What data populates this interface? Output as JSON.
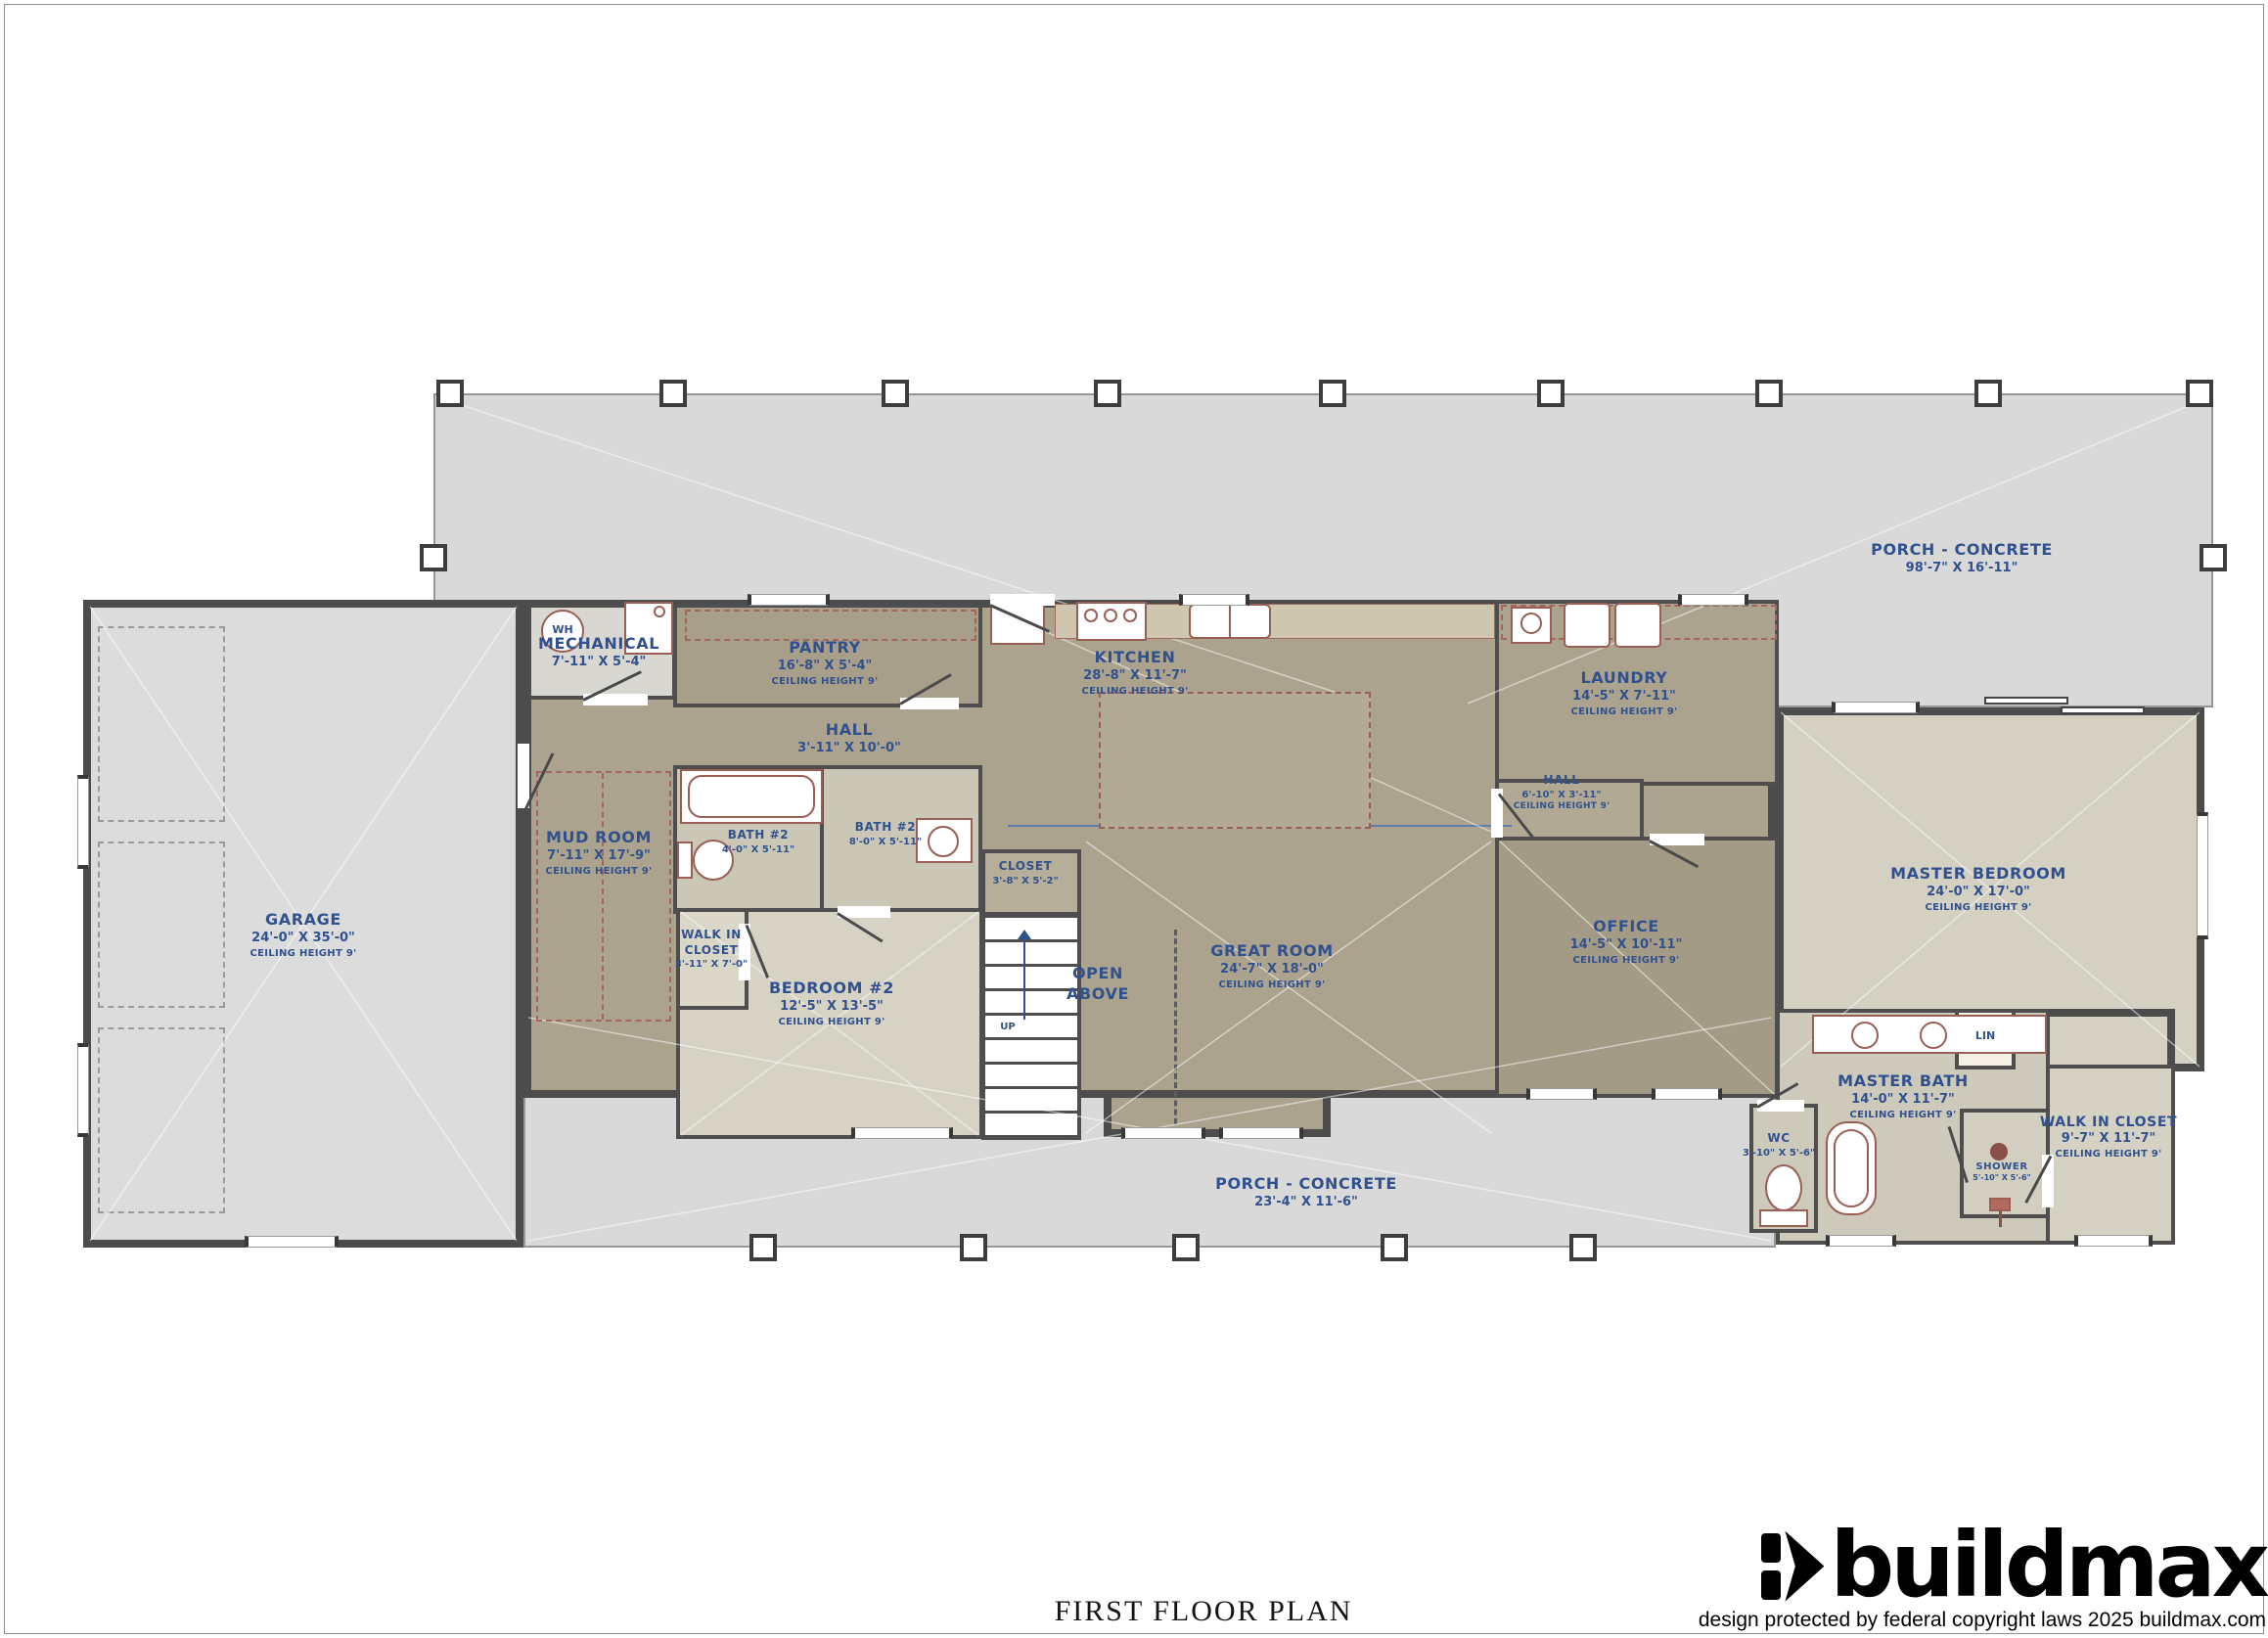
{
  "title": "FIRST FLOOR PLAN",
  "brand": {
    "wordmark": "buildmax",
    "copyright": "design protected by federal copyright laws 2025 buildmax.com"
  },
  "colors": {
    "label_blue": "#31518e",
    "wall_dark": "#4c4c4c",
    "porch_grey": "#d9d9d9",
    "room_taupe": "#aca38e",
    "room_light": "#d6d2c4",
    "bath_tan": "#cdc9bb",
    "fixture_red": "#995e54"
  },
  "rooms": {
    "porch_top": {
      "name": "PORCH - CONCRETE",
      "dims": "98'-7\" X 16'-11\""
    },
    "porch_bottom": {
      "name": "PORCH - CONCRETE",
      "dims": "23'-4\" X 11'-6\""
    },
    "garage": {
      "name": "GARAGE",
      "dims": "24'-0\" X 35'-0\"",
      "ceiling": "CEILING HEIGHT 9'"
    },
    "mechanical": {
      "name": "MECHANICAL",
      "dims": "7'-11\" X 5'-4\""
    },
    "pantry": {
      "name": "PANTRY",
      "dims": "16'-8\" X 5'-4\"",
      "ceiling": "CEILING HEIGHT 9'"
    },
    "hall_top": {
      "name": "HALL",
      "dims": "3'-11\" X 10'-0\""
    },
    "kitchen": {
      "name": "KITCHEN",
      "dims": "28'-8\" X 11'-7\"",
      "ceiling": "CEILING HEIGHT 9'"
    },
    "laundry": {
      "name": "LAUNDRY",
      "dims": "14'-5\" X 7'-11\"",
      "ceiling": "CEILING HEIGHT 9'"
    },
    "hall_right": {
      "name": "HALL",
      "dims": "6'-10\" X 3'-11\"",
      "ceiling": "CEILING HEIGHT 9'"
    },
    "mud_room": {
      "name": "MUD ROOM",
      "dims": "7'-11\" X 17'-9\"",
      "ceiling": "CEILING HEIGHT 9'"
    },
    "bath2_a": {
      "name": "BATH #2",
      "dims": "4'-0\" X 5'-11\""
    },
    "bath2_b": {
      "name": "BATH #2",
      "dims": "8'-0\" X 5'-11\""
    },
    "closet": {
      "name": "CLOSET",
      "dims": "3'-8\" X 5'-2\""
    },
    "walk_in_closet_left": {
      "name": "WALK IN CLOSET",
      "dims": "3'-11\" X 7'-0\""
    },
    "bedroom2": {
      "name": "BEDROOM #2",
      "dims": "12'-5\" X 13'-5\"",
      "ceiling": "CEILING HEIGHT 9'"
    },
    "open_above": {
      "name": "OPEN ABOVE"
    },
    "great_room": {
      "name": "GREAT ROOM",
      "dims": "24'-7\" X 18'-0\"",
      "ceiling": "CEILING HEIGHT 9'"
    },
    "office": {
      "name": "OFFICE",
      "dims": "14'-5\" X 10'-11\"",
      "ceiling": "CEILING HEIGHT 9'"
    },
    "master_bedroom": {
      "name": "MASTER BEDROOM",
      "dims": "24'-0\" X 17'-0\"",
      "ceiling": "CEILING HEIGHT 9'"
    },
    "master_bath": {
      "name": "MASTER BATH",
      "dims": "14'-0\" X 11'-7\"",
      "ceiling": "CEILING HEIGHT 9'"
    },
    "walk_in_closet_right": {
      "name": "WALK IN CLOSET",
      "dims": "9'-7\" X 11'-7\"",
      "ceiling": "CEILING HEIGHT 9'"
    },
    "wc": {
      "name": "WC",
      "dims": "3'-10\" X 5'-6\""
    },
    "shower": {
      "name": "SHOWER",
      "dims": "5'-10\" X 5'-6\""
    }
  },
  "labels": {
    "up": "UP",
    "wh": "WH",
    "lin": "LIN"
  }
}
